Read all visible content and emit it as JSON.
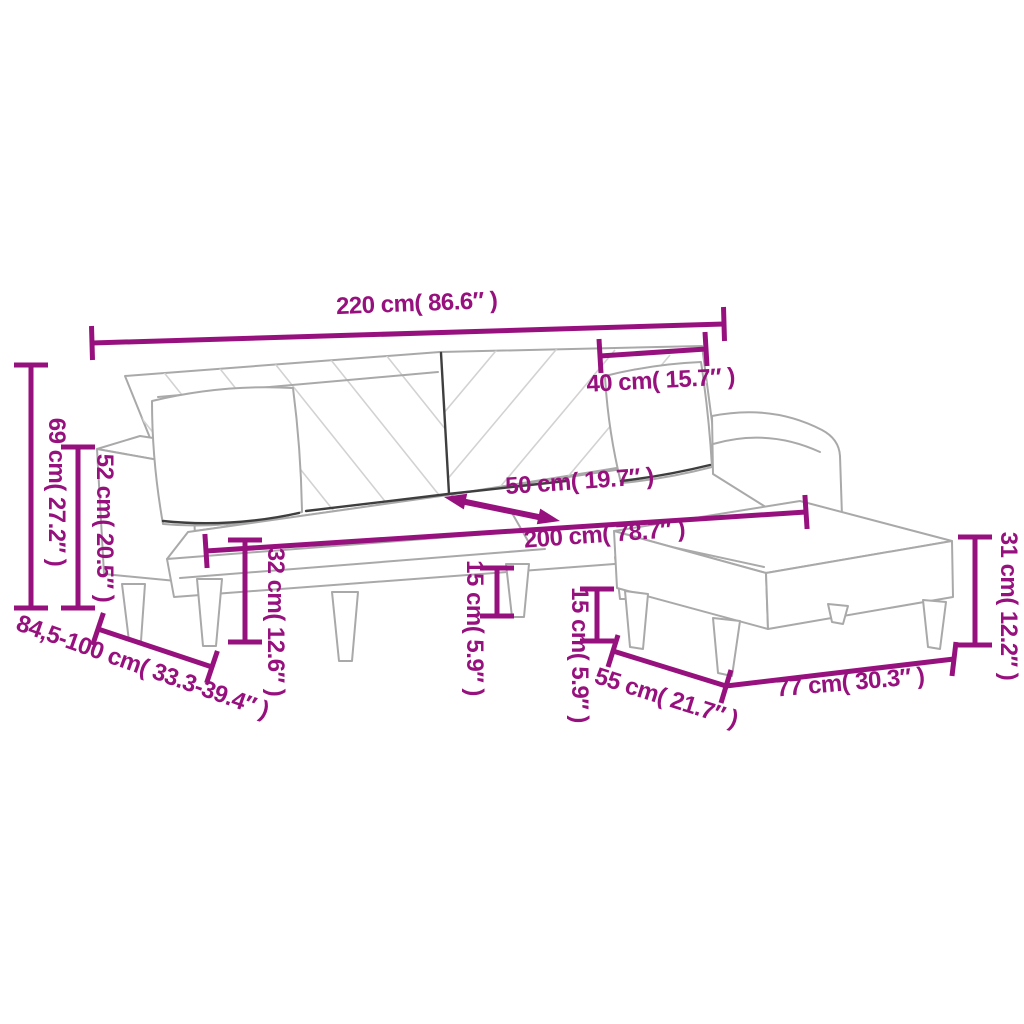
{
  "diagram": {
    "type": "furniture-dimension-diagram",
    "subject": "sofa-bed-with-two-pillows-and-footstool",
    "background_color": "#ffffff",
    "accent_color": "#97117e",
    "artwork_line_color": "#a9a9a9",
    "dimensions": [
      {
        "id": "sofa-total-width",
        "label": "220 cm( 86.6″ )"
      },
      {
        "id": "pillow-width",
        "label": "40 cm( 15.7″ )"
      },
      {
        "id": "sofa-back-height",
        "label": "69 cm( 27.2″ )"
      },
      {
        "id": "armrest-height",
        "label": "52 cm( 20.5″ )"
      },
      {
        "id": "sofa-depth-range",
        "label": "84,5-100 cm( 33.3-39.4″ )"
      },
      {
        "id": "seat-depth",
        "label": "50 cm( 19.7″ )"
      },
      {
        "id": "seat-width",
        "label": "200 cm( 78.7″ )"
      },
      {
        "id": "seat-height",
        "label": "32 cm( 12.6″ )"
      },
      {
        "id": "sofa-leg-height",
        "label": "15 cm( 5.9″ )"
      },
      {
        "id": "footstool-leg-height",
        "label": "15 cm( 5.9″ )"
      },
      {
        "id": "footstool-height",
        "label": "31 cm( 12.2″ )"
      },
      {
        "id": "footstool-depth",
        "label": "55 cm( 21.7″ )"
      },
      {
        "id": "footstool-width",
        "label": "77 cm( 30.3″ )"
      }
    ]
  }
}
